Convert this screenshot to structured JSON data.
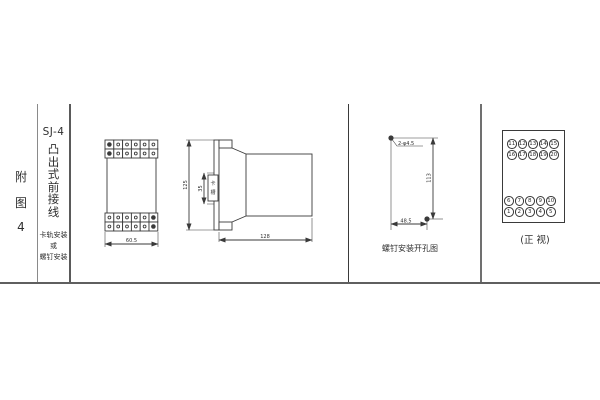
{
  "sidebar": {
    "figure_label_chars": [
      "附",
      "图",
      "4"
    ],
    "model": "SJ-4",
    "type_chars": [
      "凸",
      "出",
      "式",
      "前",
      "接",
      "线"
    ],
    "note_lines": [
      "卡轨安装",
      "或",
      "螺钉安装"
    ]
  },
  "front_view": {
    "width_dim": "60.5"
  },
  "side_view": {
    "height_dim": "125",
    "slot_dim": "35",
    "slot_label_chars": [
      "卡",
      "槽"
    ],
    "depth_dim": "128"
  },
  "drill_view": {
    "holes_label": "2-φ4.5",
    "height_dim": "113",
    "width_dim": "48.5",
    "caption": "螺钉安装开孔图"
  },
  "terminal_view": {
    "caption": "(正 视)",
    "rows": {
      "top1": [
        "11",
        "12",
        "13",
        "14",
        "15"
      ],
      "top2": [
        "16",
        "17",
        "18",
        "19",
        "20"
      ],
      "bottom1": [
        "6",
        "7",
        "8",
        "9",
        "10"
      ],
      "bottom2": [
        "1",
        "2",
        "3",
        "4",
        "5"
      ]
    }
  },
  "colors": {
    "line": "#3a3a3a",
    "grid": "#6e6e6e",
    "text": "#2e2e2e"
  }
}
